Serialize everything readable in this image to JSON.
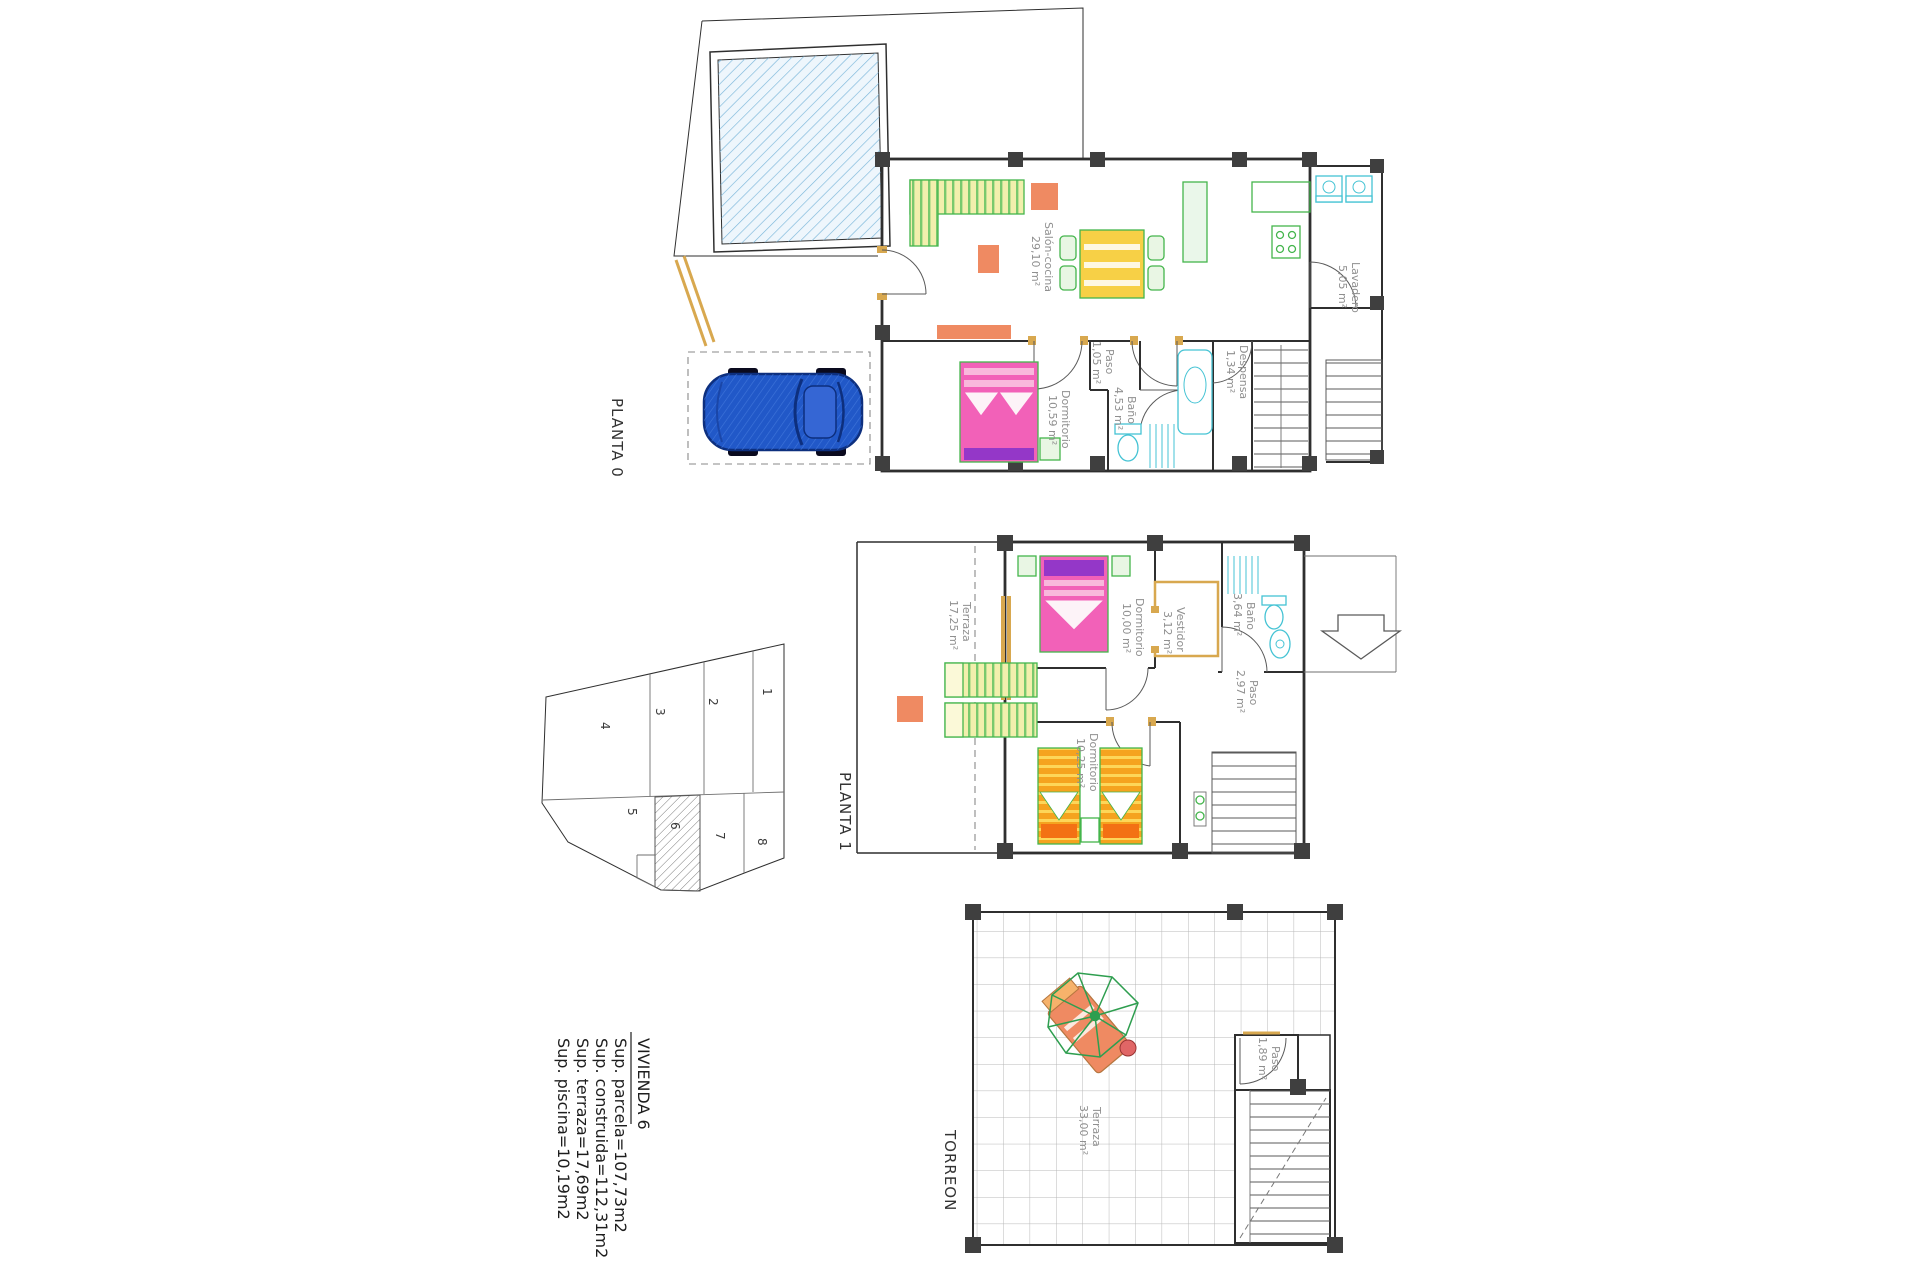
{
  "summary": {
    "title": "VIVIENDA  6",
    "lines": [
      "Sup.  parcela=107,73m2",
      "Sup.  construida=112,31m2",
      "Sup.  terraza=17,69m2",
      "Sup.  piscina=10,19m2"
    ]
  },
  "plans": {
    "planta0": {
      "title": "PLANTA 0",
      "rooms": [
        {
          "name": "Salón-cocina",
          "area": "29,10 m²"
        },
        {
          "name": "Dormitorio",
          "area": "10,59 m²"
        },
        {
          "name": "Paso",
          "area": "1,05 m²"
        },
        {
          "name": "Baño",
          "area": "4,53 m²"
        },
        {
          "name": "Despensa",
          "area": "1,34 m²"
        },
        {
          "name": "Lavadero",
          "area": "5,05 m²"
        }
      ]
    },
    "planta1": {
      "title": "PLANTA 1",
      "rooms": [
        {
          "name": "Terraza",
          "area": "17,25 m²"
        },
        {
          "name": "Dormitorio",
          "area": "10,00 m²"
        },
        {
          "name": "Vestidor",
          "area": "3,12 m²"
        },
        {
          "name": "Baño",
          "area": "3,64 m²"
        },
        {
          "name": "Paso",
          "area": "2,97 m²"
        },
        {
          "name": "Dormitorio",
          "area": "10,25 m²"
        }
      ]
    },
    "torreon": {
      "title": "TORREON",
      "rooms": [
        {
          "name": "Terraza",
          "area": "33,00 m²"
        },
        {
          "name": "Paso",
          "area": "1,89 m²"
        }
      ]
    }
  },
  "site_plan": {
    "lots": [
      "1",
      "2",
      "3",
      "4",
      "5",
      "6",
      "7",
      "8"
    ],
    "highlighted_lot": "6"
  },
  "colors": {
    "wall": "#2f2f2f",
    "wood_tan": "#d8a84f",
    "furniture_green": "#44b54c",
    "sofa_yellow": "#f2efad",
    "coral": "#ef8a62",
    "bed_pink": "#f261b8",
    "pillow_purple": "#9437c8",
    "bed_orange": "#f5a31f",
    "fixture_cyan": "#45c3d4",
    "pool_blue": "#7ab6da",
    "car_blue": "#2158c8",
    "table_yellow": "#f7d046"
  }
}
